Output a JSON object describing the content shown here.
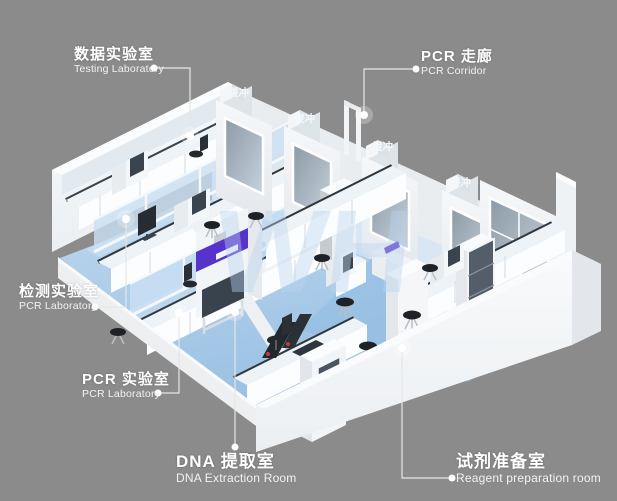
{
  "diagram": {
    "type": "isometric-laboratory-floorplan",
    "watermark": "WH",
    "colors": {
      "background": "#8B8B8B",
      "wall_white": "#F2F5F7",
      "floor_blue": "#A6C8E8",
      "corridor_floor": "#DAE7F4",
      "countertop_dark": "#2F363E",
      "accent_purple": "#5633CB",
      "glass": "#9AA8B4",
      "label_text": "#FFFFFF",
      "leader_line": "#E6E6E6",
      "watermark_blue": "#B9D3EE"
    }
  },
  "callouts": [
    {
      "id": "testing-laboratory",
      "zh": "数据实验室",
      "en": "Testing Laboratory"
    },
    {
      "id": "pcr-corridor",
      "zh": "PCR 走廊",
      "en": "PCR Corridor"
    },
    {
      "id": "pcr-laboratory-left",
      "zh": "检测实验室",
      "en": "PCR Laboratory"
    },
    {
      "id": "pcr-laboratory",
      "zh": "PCR 实验室",
      "en": "PCR Laboratory"
    },
    {
      "id": "dna-extraction-room",
      "zh": "DNA 提取室",
      "en": "DNA Extraction Room"
    },
    {
      "id": "reagent-preparation-room",
      "zh": "试剂准备室",
      "en": "Reagent preparation room"
    }
  ],
  "room_tags": [
    {
      "label": "缓冲"
    },
    {
      "label": "缓冲"
    },
    {
      "label": "缓冲"
    },
    {
      "label": "缓冲"
    }
  ]
}
